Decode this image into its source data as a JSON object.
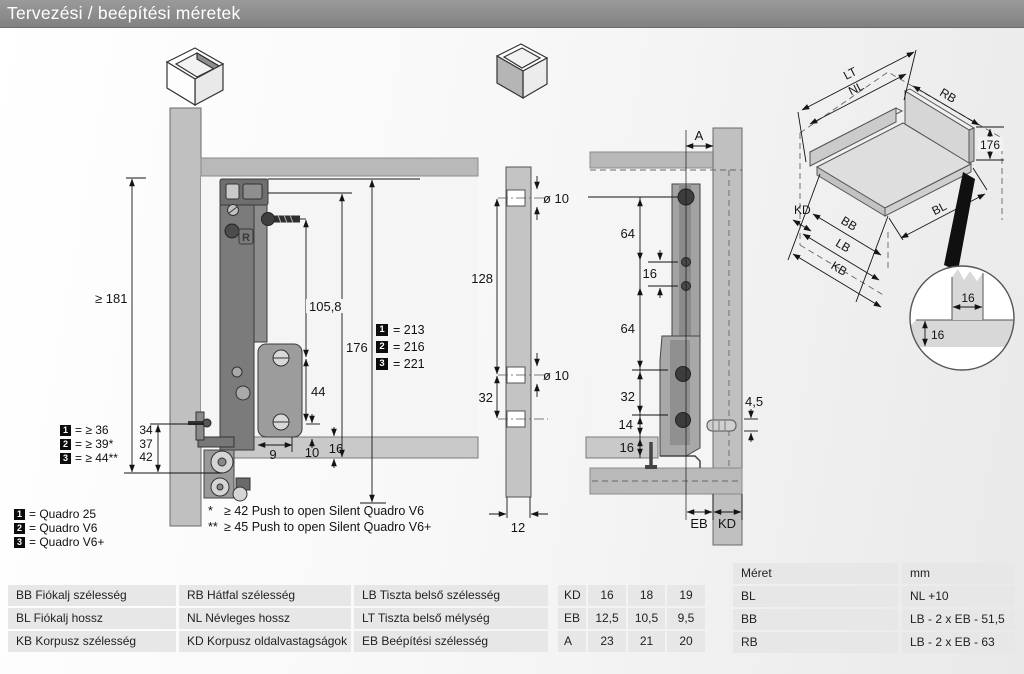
{
  "title": "Tervezési / beépítési méretek",
  "colors": {
    "title_bar": "#8c8c8c",
    "panel_gray": "#c0c0c0",
    "runner_gray": "#787878",
    "table_cell": "#e7e7e7"
  },
  "diagram_side": {
    "dim_min_height": "≥ 181",
    "dim_hole_top": "105,8",
    "dim_height": "176",
    "dim_hole_spacing": "44",
    "dim_front_offset": "9",
    "dim_base_inset": "10",
    "dim_base_thickness": "16",
    "marking": "R",
    "total_heights": [
      {
        "n": "1",
        "value": "= 213"
      },
      {
        "n": "2",
        "value": "= 216"
      },
      {
        "n": "3",
        "value": "= 221"
      }
    ],
    "bottom_clearances": [
      {
        "n": "1",
        "value": "= ≥ 36"
      },
      {
        "n": "2",
        "value": "= ≥ 39*"
      },
      {
        "n": "3",
        "value": "= ≥ 44**"
      }
    ],
    "bottom_stack": [
      "34",
      "37",
      "42"
    ]
  },
  "legend": [
    {
      "n": "1",
      "label": "= Quadro 25"
    },
    {
      "n": "2",
      "label": "= Quadro V6"
    },
    {
      "n": "3",
      "label": "= Quadro V6+"
    }
  ],
  "footnotes": [
    {
      "marker": "*",
      "text": "≥ 42 Push to open Silent Quadro V6"
    },
    {
      "marker": "**",
      "text": "≥ 45 Push to open Silent Quadro V6+"
    }
  ],
  "diagram_back": {
    "dim_top_spacing": "128",
    "dim_bottom_spacing": "32",
    "dim_hole_dia_top": "ø 10",
    "dim_hole_dia_mid": "ø 10",
    "dim_thickness": "12"
  },
  "diagram_front": {
    "dim_a": "A",
    "dim_64_top": "64",
    "dim_16_mid": "16",
    "dim_64_bottom": "64",
    "dim_32": "32",
    "dim_14": "14",
    "dim_16_base": "16",
    "dim_screw": "4,5",
    "label_eb": "EB",
    "label_kd": "KD"
  },
  "iso": {
    "labels": {
      "lt": "LT",
      "nl": "NL",
      "rb": "RB",
      "h176": "176",
      "kd": "KD",
      "bb": "BB",
      "bl": "BL",
      "lb": "LB",
      "kb": "KB"
    },
    "detail": {
      "dim_h": "16",
      "dim_v": "16"
    }
  },
  "tables": {
    "definitions": [
      [
        "BB Fiókalj szélesség",
        "RB Hátfal szélesség",
        "LB Tiszta belső szélesség"
      ],
      [
        "BL Fiókalj hossz",
        "NL Névleges hossz",
        "LT Tiszta belső mélység"
      ],
      [
        "KB Korpusz szélesség",
        "KD Korpusz oldalvastagságok",
        "EB Beépítési szélesség"
      ]
    ],
    "values": {
      "rows": [
        {
          "label": "KD",
          "v": [
            "16",
            "18",
            "19"
          ]
        },
        {
          "label": "EB",
          "v": [
            "12,5",
            "10,5",
            "9,5"
          ]
        },
        {
          "label": "A",
          "v": [
            "23",
            "21",
            "20"
          ]
        }
      ]
    },
    "formulas": {
      "header": [
        "Méret",
        "mm"
      ],
      "rows": [
        [
          "BL",
          "NL +10"
        ],
        [
          "BB",
          "LB - 2 x EB - 51,5"
        ],
        [
          "RB",
          "LB - 2 x EB - 63"
        ]
      ]
    }
  }
}
